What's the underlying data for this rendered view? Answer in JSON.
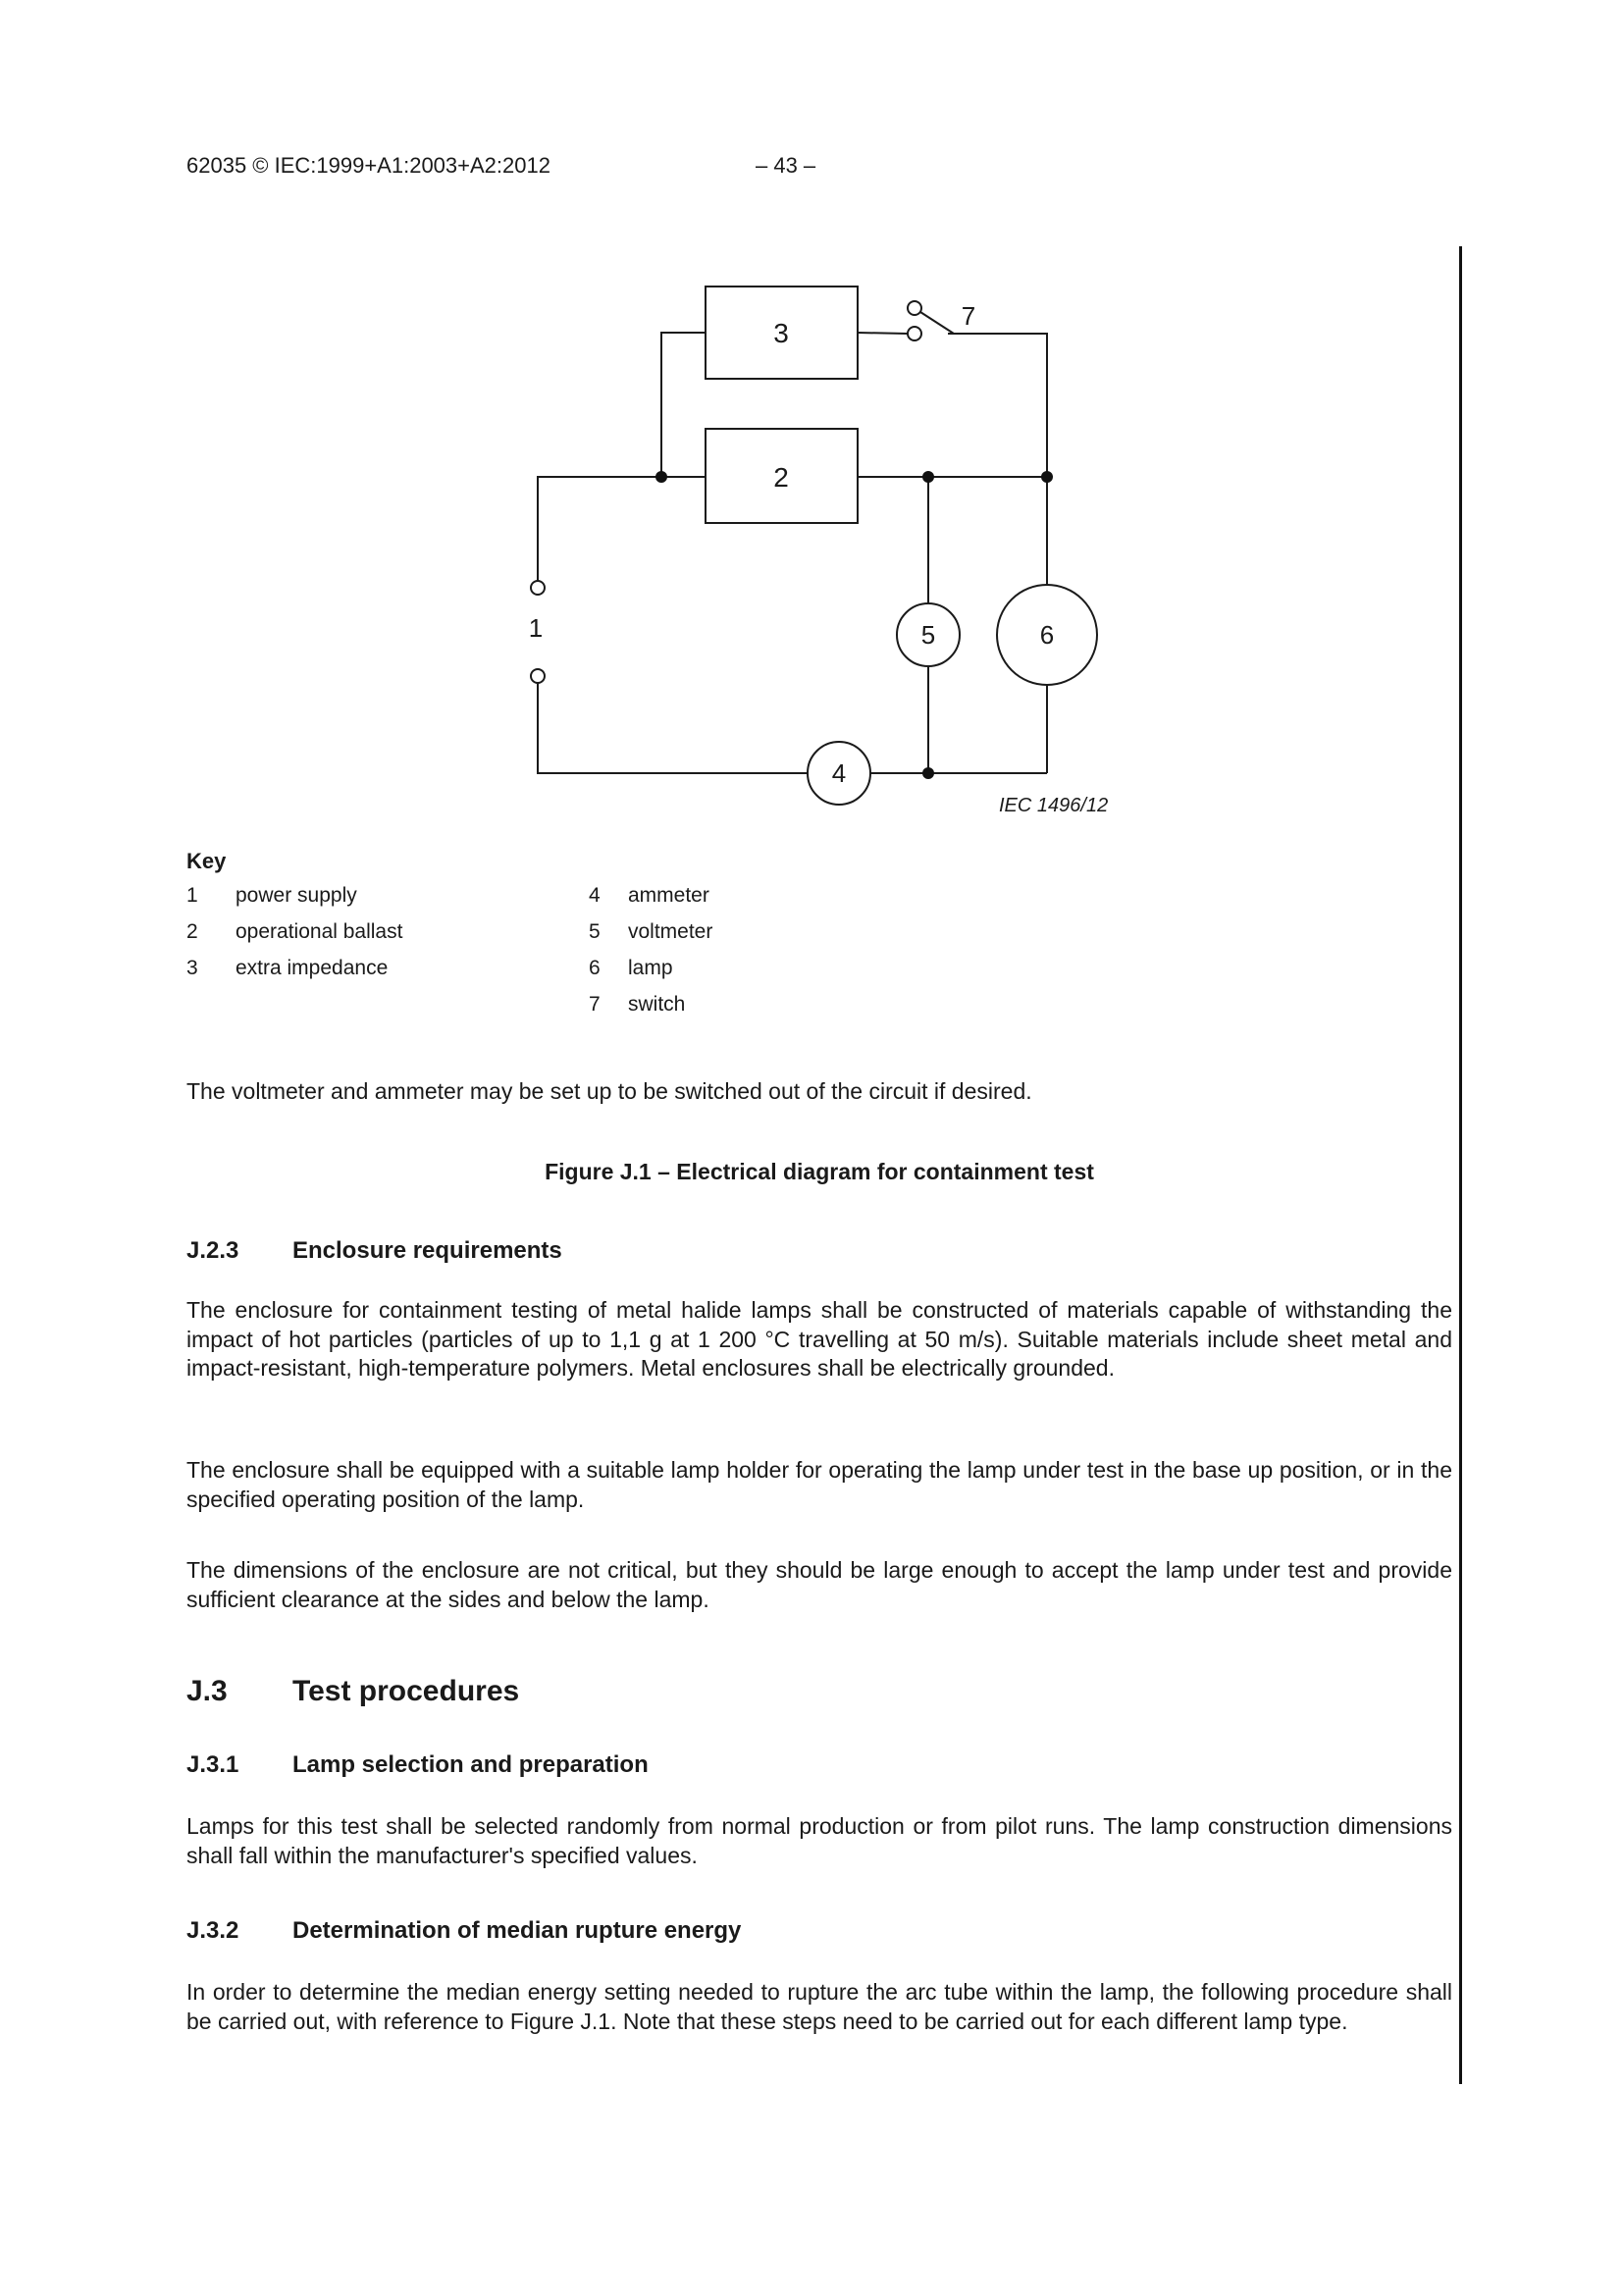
{
  "header": {
    "left": "62035 © IEC:1999+A1:2003+A2:2012",
    "page_number": "– 43 –"
  },
  "diagram": {
    "component_labels": {
      "c1": "1",
      "c2": "2",
      "c3": "3",
      "c4": "4",
      "c5": "5",
      "c6": "6",
      "c7": "7"
    },
    "ref": "IEC  1496/12"
  },
  "key": {
    "title": "Key",
    "left": [
      {
        "num": "1",
        "label": "power supply"
      },
      {
        "num": "2",
        "label": "operational ballast"
      },
      {
        "num": "3",
        "label": "extra impedance"
      }
    ],
    "right": [
      {
        "num": "4",
        "label": "ammeter"
      },
      {
        "num": "5",
        "label": "voltmeter"
      },
      {
        "num": "6",
        "label": "lamp"
      },
      {
        "num": "7",
        "label": "switch"
      }
    ]
  },
  "body": {
    "note": "The voltmeter and ammeter may be set up to be switched out of the circuit if desired.",
    "figure_caption": "Figure J.1 – Electrical diagram for containment test",
    "sections": {
      "j23": {
        "num": "J.2.3",
        "title": "Enclosure requirements",
        "p1": "The enclosure for containment testing of metal halide lamps shall be constructed of materials capable of withstanding the impact of hot particles (particles of up to 1,1 g at 1 200 °C travelling at 50 m/s). Suitable materials include sheet metal and impact-resistant, high-temperature polymers. Metal enclosures shall be electrically grounded.",
        "p2": "The enclosure shall be equipped with a suitable lamp holder for operating the lamp under test in the base up position, or in the specified operating position of the lamp.",
        "p3": "The dimensions of the enclosure are not critical, but they should be large enough to accept the lamp under test and provide sufficient clearance at the sides and below the lamp."
      },
      "j3": {
        "num": "J.3",
        "title": "Test procedures"
      },
      "j31": {
        "num": "J.3.1",
        "title": "Lamp selection and preparation",
        "p1": "Lamps for this test shall be selected randomly from normal production or from pilot runs. The lamp construction dimensions shall fall within the manufacturer's specified values."
      },
      "j32": {
        "num": "J.3.2",
        "title": "Determination of median rupture energy",
        "p1": "In order to determine the median energy setting needed to rupture the arc tube within the lamp, the following procedure shall be carried out, with reference to Figure J.1. Note that these steps need to be carried out for each different lamp type."
      }
    }
  }
}
